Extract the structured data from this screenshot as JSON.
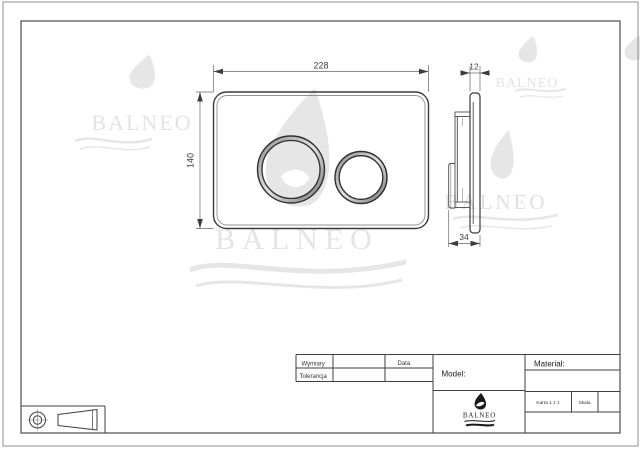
{
  "sheet": {
    "watermark": {
      "brand": "BALNEO",
      "color": "#e6e6e6"
    },
    "views": {
      "front": {
        "width_mm": "228",
        "height_mm": "140"
      },
      "side": {
        "thickness_mm": "12",
        "depth_mm": "34"
      }
    },
    "title_block": {
      "wymiary": "Wymiary",
      "tolerancja": "Tolerancja",
      "data": "Data",
      "model": "Model:",
      "material": "Materiał:",
      "karta": "Karta 1 z 1",
      "skala": "Skala",
      "brand": "BALNEO"
    },
    "colors": {
      "line": "#3d3d3d",
      "frame": "#555555",
      "text": "#333333"
    }
  }
}
